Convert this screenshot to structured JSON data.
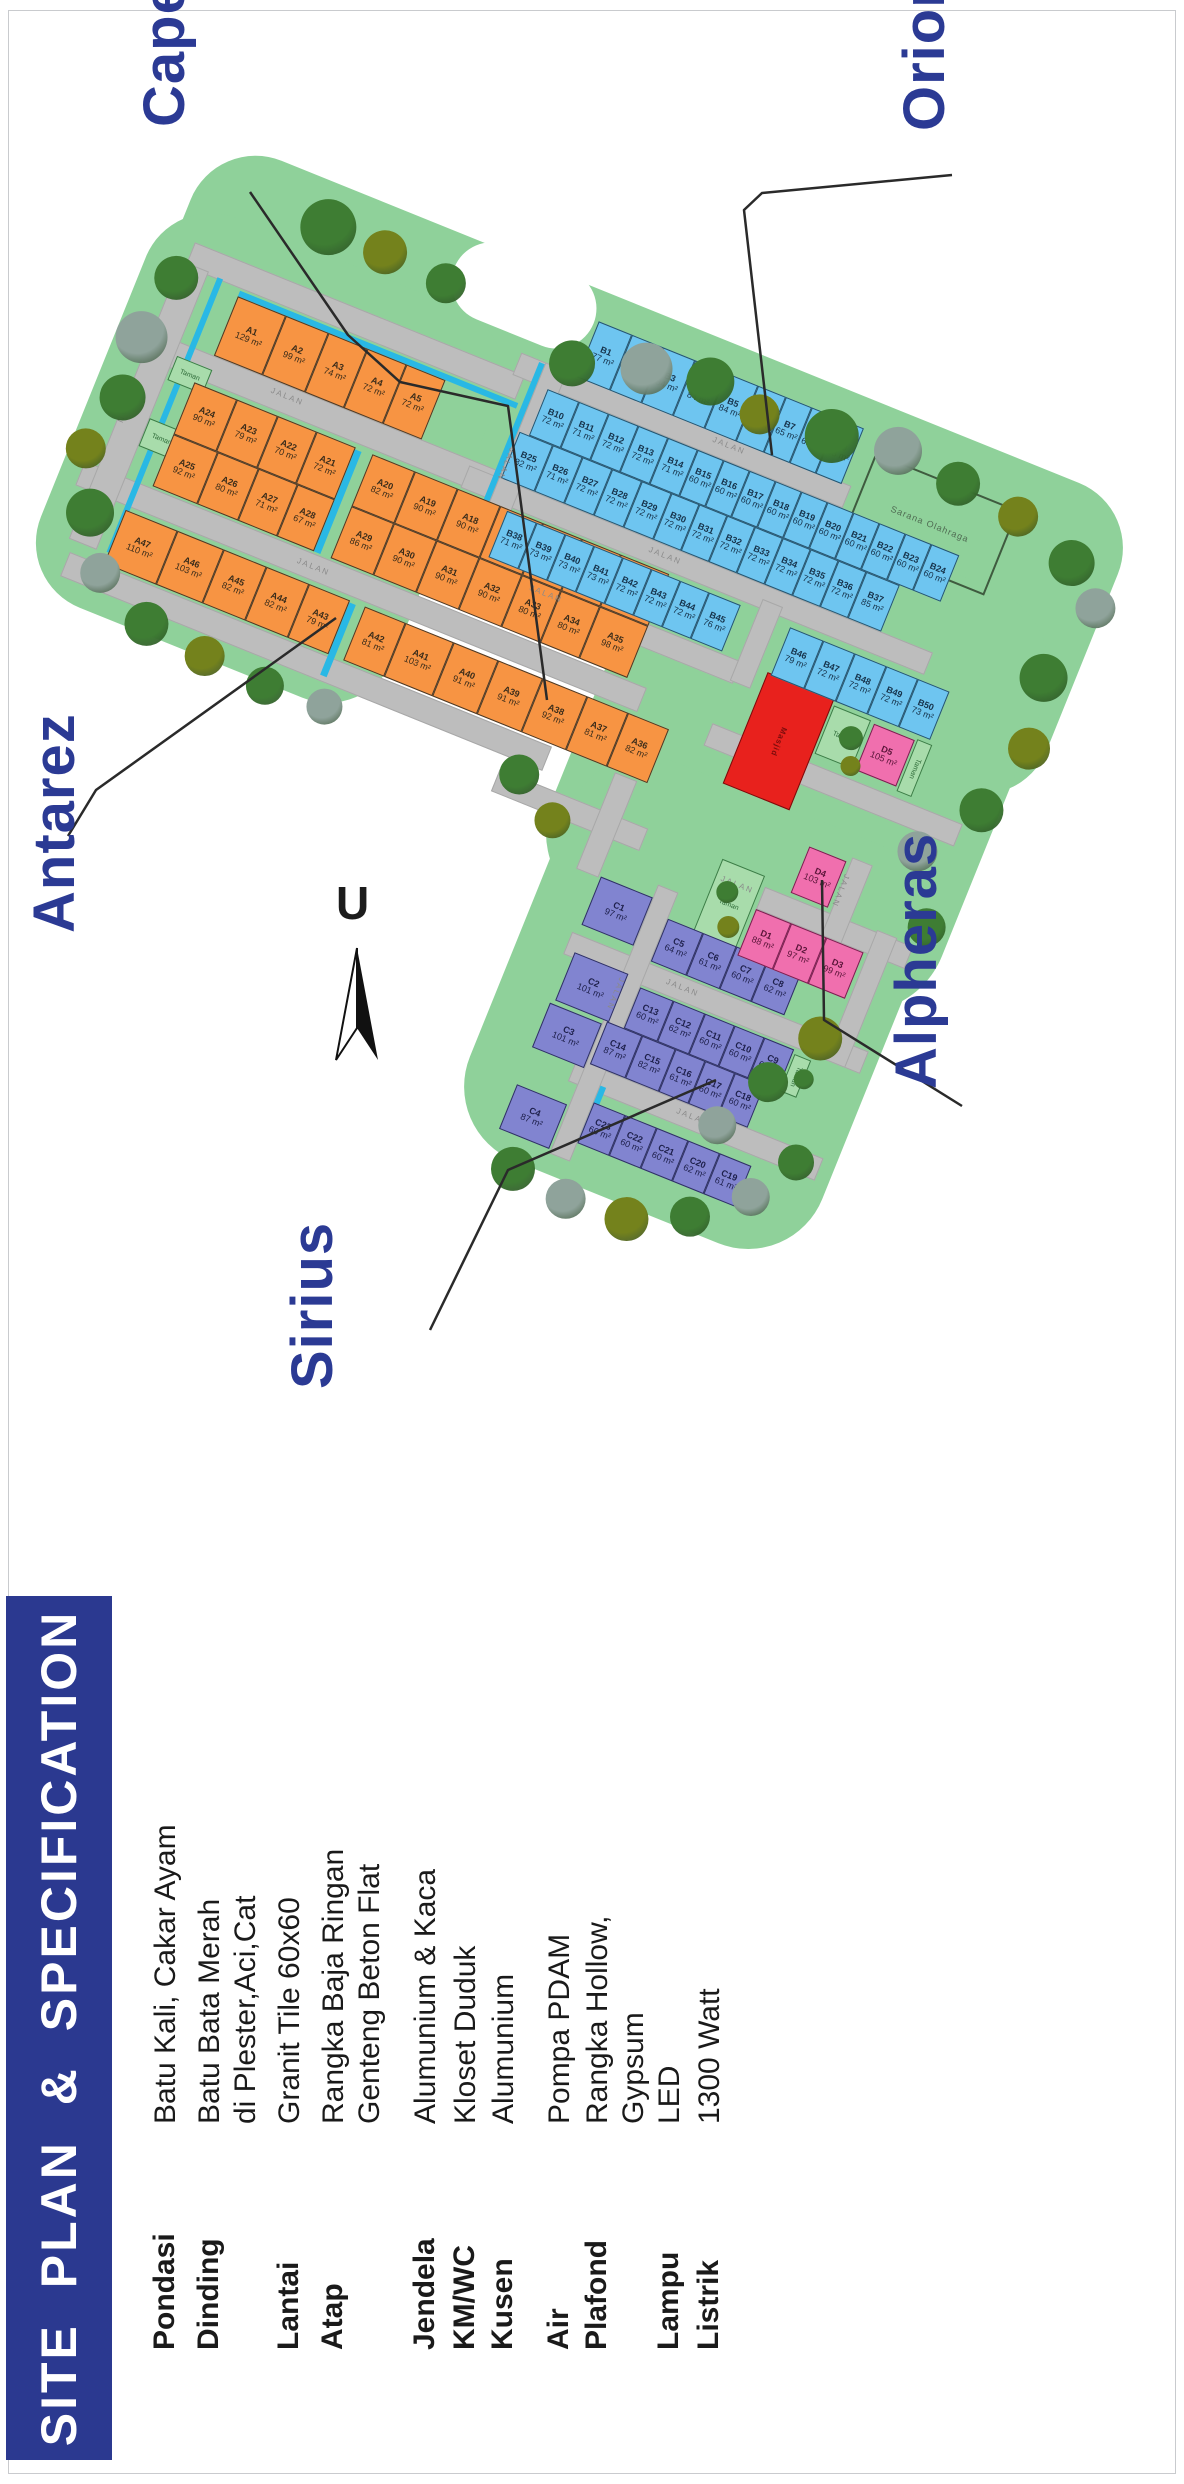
{
  "banner": {
    "title": "SITE PLAN & SPECIFICATION"
  },
  "map": {
    "north_label": "U",
    "road_label": "JALAN",
    "park_label": "Taman",
    "sports_label": "Sarana Olahraga",
    "mosque_label": "Masjid",
    "clusters": [
      {
        "name": "Capella"
      },
      {
        "name": "Orion"
      },
      {
        "name": "Antarez"
      },
      {
        "name": "Alpheras"
      },
      {
        "name": "Sirius"
      }
    ],
    "lots": {
      "a_r1": [
        {
          "id": "A1",
          "area": "129 m²"
        },
        {
          "id": "A2",
          "area": "99 m²"
        },
        {
          "id": "A3",
          "area": "74 m²"
        },
        {
          "id": "A4",
          "area": "72 m²"
        },
        {
          "id": "A5",
          "area": "72 m²"
        }
      ],
      "a_r2a": [
        {
          "id": "A24",
          "area": "90 m²"
        },
        {
          "id": "A23",
          "area": "79 m²"
        },
        {
          "id": "A22",
          "area": "70 m²"
        },
        {
          "id": "A21",
          "area": "72 m²"
        }
      ],
      "a_r2b": [
        {
          "id": "A20",
          "area": "82 m²"
        },
        {
          "id": "A19",
          "area": "90 m²"
        },
        {
          "id": "A18",
          "area": "90 m²"
        },
        {
          "id": "A17",
          "area": "90 m²"
        },
        {
          "id": "A16",
          "area": "80 m²"
        },
        {
          "id": "A15",
          "area": "80 m²"
        },
        {
          "id": "A14",
          "area": "102 m²"
        }
      ],
      "a_r3a": [
        {
          "id": "A25",
          "area": "92 m²"
        },
        {
          "id": "A26",
          "area": "80 m²"
        },
        {
          "id": "A27",
          "area": "71 m²"
        },
        {
          "id": "A28",
          "area": "67 m²"
        }
      ],
      "a_r3b": [
        {
          "id": "A29",
          "area": "86 m²"
        },
        {
          "id": "A30",
          "area": "90 m²"
        },
        {
          "id": "A31",
          "area": "90 m²"
        },
        {
          "id": "A32",
          "area": "90 m²"
        },
        {
          "id": "A33",
          "area": "80 m²"
        },
        {
          "id": "A34",
          "area": "80 m²"
        },
        {
          "id": "A35",
          "area": "98 m²"
        }
      ],
      "a_r4a": [
        {
          "id": "A47",
          "area": "110 m²"
        },
        {
          "id": "A46",
          "area": "103 m²"
        },
        {
          "id": "A45",
          "area": "82 m²"
        },
        {
          "id": "A44",
          "area": "82 m²"
        },
        {
          "id": "A43",
          "area": "79 m²"
        }
      ],
      "a_r4b": [
        {
          "id": "A42",
          "area": "81 m²"
        },
        {
          "id": "A41",
          "area": "103 m²"
        },
        {
          "id": "A40",
          "area": "91 m²"
        },
        {
          "id": "A39",
          "area": "91 m²"
        },
        {
          "id": "A38",
          "area": "92 m²"
        },
        {
          "id": "A37",
          "area": "81 m²"
        },
        {
          "id": "A36",
          "area": "82 m²"
        }
      ],
      "b_r1": [
        {
          "id": "B1",
          "area": "77 m²"
        },
        {
          "id": "B2",
          "area": "81 m²"
        },
        {
          "id": "B3",
          "area": "84 m²"
        },
        {
          "id": "B4",
          "area": "84 m²"
        },
        {
          "id": "B5",
          "area": "84 m²"
        },
        {
          "id": "B6",
          "area": "65 m²"
        },
        {
          "id": "B7",
          "area": "65 m²"
        },
        {
          "id": "B8",
          "area": "63 m²"
        },
        {
          "id": "B9",
          "area": "63 m²"
        }
      ],
      "b_r2": [
        {
          "id": "B10",
          "area": "72 m²"
        },
        {
          "id": "B11",
          "area": "71 m²"
        },
        {
          "id": "B12",
          "area": "72 m²"
        },
        {
          "id": "B13",
          "area": "72 m²"
        },
        {
          "id": "B14",
          "area": "71 m²"
        },
        {
          "id": "B15",
          "area": "60 m²"
        },
        {
          "id": "B16",
          "area": "60 m²"
        },
        {
          "id": "B17",
          "area": "60 m²"
        },
        {
          "id": "B18",
          "area": "60 m²"
        },
        {
          "id": "B19",
          "area": "60 m²"
        },
        {
          "id": "B20",
          "area": "60 m²"
        },
        {
          "id": "B21",
          "area": "60 m²"
        },
        {
          "id": "B22",
          "area": "60 m²"
        },
        {
          "id": "B23",
          "area": "60 m²"
        },
        {
          "id": "B24",
          "area": "60 m²"
        }
      ],
      "b_r3": [
        {
          "id": "B25",
          "area": "82 m²"
        },
        {
          "id": "B26",
          "area": "71 m²"
        },
        {
          "id": "B27",
          "area": "72 m²"
        },
        {
          "id": "B28",
          "area": "72 m²"
        },
        {
          "id": "B29",
          "area": "72 m²"
        },
        {
          "id": "B30",
          "area": "72 m²"
        },
        {
          "id": "B31",
          "area": "72 m²"
        },
        {
          "id": "B32",
          "area": "72 m²"
        },
        {
          "id": "B33",
          "area": "72 m²"
        },
        {
          "id": "B34",
          "area": "72 m²"
        },
        {
          "id": "B35",
          "area": "72 m²"
        },
        {
          "id": "B36",
          "area": "72 m²"
        },
        {
          "id": "B37",
          "area": "85 m²"
        }
      ],
      "b_r4": [
        {
          "id": "B38",
          "area": "71 m²"
        },
        {
          "id": "B39",
          "area": "73 m²"
        },
        {
          "id": "B40",
          "area": "73 m²"
        },
        {
          "id": "B41",
          "area": "73 m²"
        },
        {
          "id": "B42",
          "area": "72 m²"
        },
        {
          "id": "B43",
          "area": "72 m²"
        },
        {
          "id": "B44",
          "area": "72 m²"
        },
        {
          "id": "B45",
          "area": "76 m²"
        }
      ],
      "b_r5": [
        {
          "id": "B46",
          "area": "79 m²"
        },
        {
          "id": "B47",
          "area": "72 m²"
        },
        {
          "id": "B48",
          "area": "72 m²"
        },
        {
          "id": "B49",
          "area": "72 m²"
        },
        {
          "id": "B50",
          "area": "73 m²"
        }
      ],
      "c_r1": [
        {
          "id": "C1",
          "area": "97 m²"
        }
      ],
      "c_r2": [
        {
          "id": "C2",
          "area": "101 m²"
        }
      ],
      "c_r3": [
        {
          "id": "C3",
          "area": "101 m²"
        }
      ],
      "c_r4": [
        {
          "id": "C4",
          "area": "87 m²"
        }
      ],
      "c_r5": [
        {
          "id": "C5",
          "area": "64 m²"
        },
        {
          "id": "C6",
          "area": "61 m²"
        },
        {
          "id": "C7",
          "area": "60 m²"
        },
        {
          "id": "C8",
          "area": "62 m²"
        }
      ],
      "c_r13": [
        {
          "id": "C13",
          "area": "60 m²"
        },
        {
          "id": "C12",
          "area": "62 m²"
        },
        {
          "id": "C11",
          "area": "60 m²"
        },
        {
          "id": "C10",
          "area": "60 m²"
        },
        {
          "id": "C9",
          "area": "61 m²"
        }
      ],
      "c_r14": [
        {
          "id": "C14",
          "area": "87 m²"
        },
        {
          "id": "C15",
          "area": "82 m²"
        },
        {
          "id": "C16",
          "area": "61 m²"
        },
        {
          "id": "C17",
          "area": "60 m²"
        },
        {
          "id": "C18",
          "area": "60 m²"
        }
      ],
      "c_r23": [
        {
          "id": "C23",
          "area": "60 m²"
        },
        {
          "id": "C22",
          "area": "60 m²"
        },
        {
          "id": "C21",
          "area": "60 m²"
        },
        {
          "id": "C20",
          "area": "62 m²"
        },
        {
          "id": "C19",
          "area": "61 m²"
        }
      ],
      "d_r1": [
        {
          "id": "D1",
          "area": "88 m²"
        },
        {
          "id": "D2",
          "area": "97 m²"
        },
        {
          "id": "D3",
          "area": "99 m²"
        }
      ],
      "d_r4": [
        {
          "id": "D4",
          "area": "103 m²"
        }
      ],
      "d_r5": [
        {
          "id": "D5",
          "area": "105 m²"
        }
      ]
    }
  },
  "specifications": [
    {
      "label": "Pondasi",
      "value": "Batu Kali, Cakar Ayam"
    },
    {
      "label": "Dinding",
      "value": "Batu Bata Merah\ndi Plester,Aci,Cat"
    },
    {
      "label": "Lantai",
      "value": "Granit Tile 60x60"
    },
    {
      "label": "Atap",
      "value": "Rangka Baja Ringan\nGenteng Beton Flat"
    },
    {
      "label": "Jendela",
      "value": "Alumunium & Kaca"
    },
    {
      "label": "KM/WC",
      "value": "Kloset Duduk"
    },
    {
      "label": "Kusen",
      "value": "Alumunium"
    },
    {
      "label": "Air",
      "value": "Pompa PDAM"
    },
    {
      "label": "Plafond",
      "value": "Rangka Hollow,\nGypsum"
    },
    {
      "label": "Lampu",
      "value": "LED"
    },
    {
      "label": "Listrik",
      "value": "1300 Watt"
    }
  ],
  "colors": {
    "banner_blue": "#2b3990",
    "cluster_blue": "#2b3a94",
    "lot_a_orange": "#f79443",
    "lot_b_blue": "#6ec5f0",
    "lot_c_purple": "#8184d0",
    "lot_d_pink": "#f06fae",
    "mosque_red": "#e8211d",
    "green_area": "#8fd19a",
    "road_gray": "#bdbdbd",
    "water_cyan": "#29b8e5"
  }
}
